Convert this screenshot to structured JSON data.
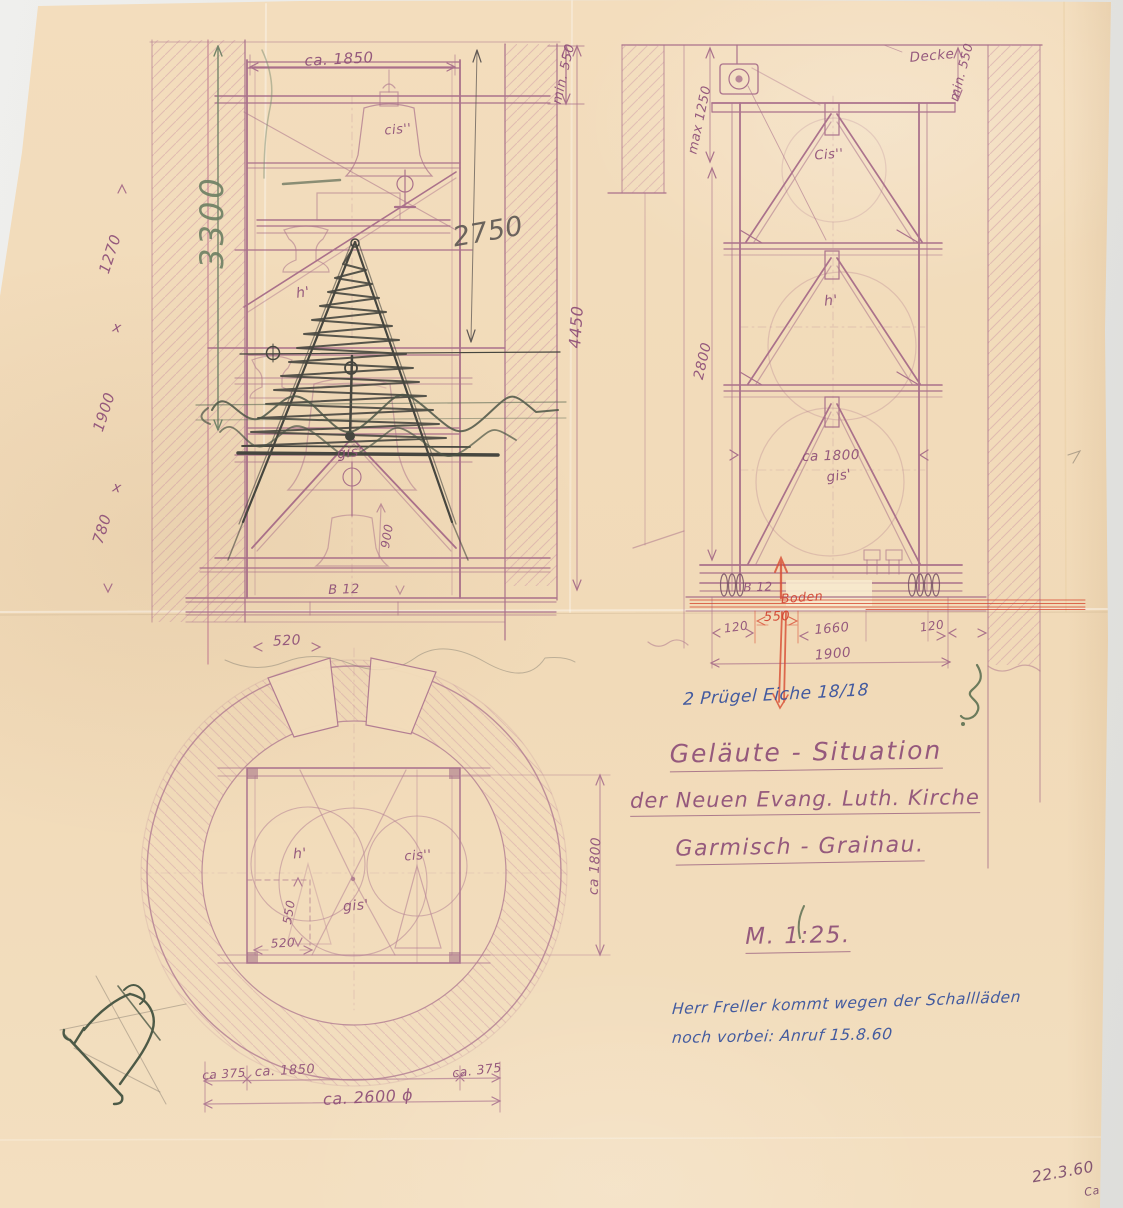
{
  "page": {
    "paper_color": "#f2dcbb",
    "pencil_purple": "#8e4f78",
    "pencil_green": "#6f8164",
    "ink_red": "#d2402e",
    "ink_blue": "#35509d"
  },
  "front_elevation": {
    "dim_width_top": "ca. 1850",
    "dim_height_green": "3300",
    "dim_inner_height": "2750",
    "dim_min_top": "min. 550",
    "dim_total_height": "4450",
    "dim_wall_upper": "1270",
    "mark_x_upper": "x",
    "dim_wall_middle": "1900",
    "mark_x_lower": "x",
    "dim_wall_lower": "780",
    "dim_base_width": "520",
    "beam_label": "B 12",
    "dim_bell": "900",
    "bell_top": "cis''",
    "bell_middle": "h'",
    "bell_bottom": "gis'"
  },
  "side_elevation": {
    "ceiling_label": "Decke",
    "dim_min_top": "min. 550",
    "dim_max_left": "max 1250",
    "dim_height": "2800",
    "bell_top": "Cis''",
    "bell_middle": "h'",
    "dim_bell_dia": "ca 1800",
    "bell_bottom": "gis'",
    "beam_label": "B 12",
    "floor_label": "Boden",
    "dim_plinth": "550",
    "dim_left": "120",
    "dim_span": "1660",
    "dim_right": "120",
    "dim_total": "1900",
    "note_timber": "2 Prügel Eiche 18/18"
  },
  "plan_view": {
    "bell_left": "h'",
    "bell_right": "cis''",
    "bell_center": "gis'",
    "dim_550": "550",
    "dim_520": "520",
    "dim_inner": "ca 1800",
    "dim_wall_left": "ca 375",
    "dim_width": "ca. 1850",
    "dim_wall_right": "ca. 375",
    "dim_outer": "ca. 2600 ϕ"
  },
  "title_block": {
    "line1": "Geläute - Situation",
    "line2": "der Neuen Evang. Luth. Kirche",
    "line3": "Garmisch - Grainau.",
    "scale": "M. 1:25."
  },
  "annotations": {
    "note_line1": "Herr Freller kommt wegen der Schallläden",
    "note_line2": "noch vorbei: Anruf 15.8.60",
    "date": "22.3.60",
    "initials": "Ca."
  }
}
